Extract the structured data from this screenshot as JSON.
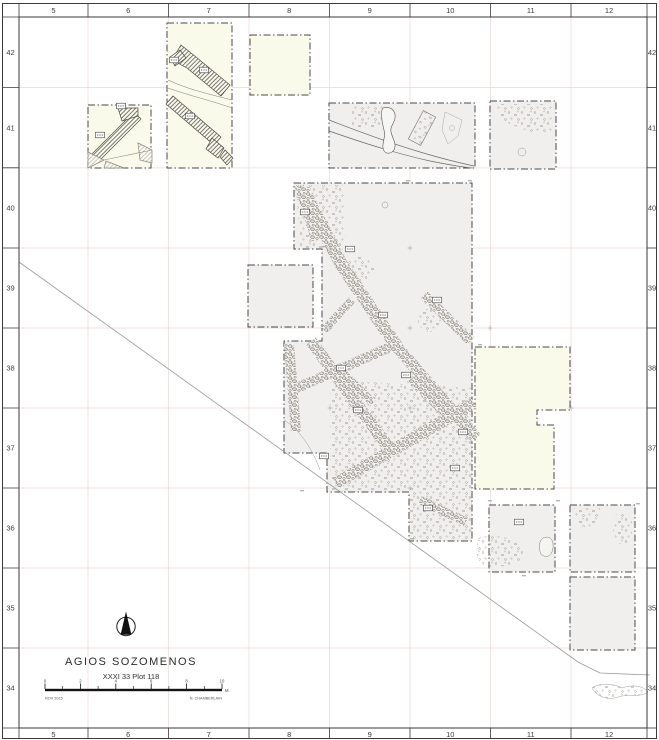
{
  "axes": {
    "top": [
      "5",
      "6",
      "7",
      "8",
      "9",
      "10",
      "11",
      "12"
    ],
    "bottom": [
      "5",
      "6",
      "7",
      "8",
      "9",
      "10",
      "11",
      "12"
    ],
    "left": [
      "42",
      "41",
      "40",
      "39",
      "38",
      "37",
      "36",
      "35",
      "34"
    ],
    "right": [
      "42",
      "41",
      "40",
      "39",
      "38",
      "37",
      "36",
      "35",
      "34"
    ]
  },
  "title_block": {
    "title": "AGIOS SOZOMENOS",
    "subtitle": "XXXI 33 Plot 118"
  },
  "scale_bar": {
    "tick_labels": [
      "0",
      "2",
      "4",
      "6",
      "8",
      "10"
    ],
    "unit": "M.",
    "date_note": "NOV 2015",
    "author_note": "N. CHAMBERLAIN"
  },
  "icons": {
    "north_arrow": "north-arrow-icon"
  },
  "colors": {
    "trench_fill": "#f0efed",
    "plot_fill_yellow": "#f9faea",
    "grid_pink": "#f0dada",
    "frame_ink": "#3a3a3a",
    "plan_ink": "#4a4a4a"
  }
}
